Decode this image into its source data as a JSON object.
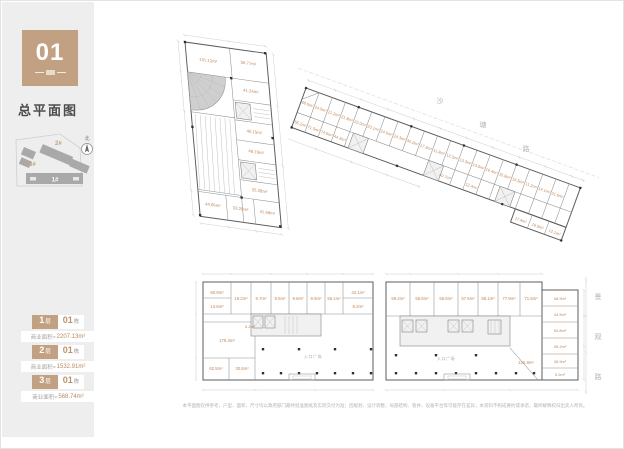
{
  "sidebar": {
    "badge": {
      "number": "01"
    },
    "title": "总平面图",
    "site_map": {
      "building_1": "1#",
      "building_2": "2#",
      "building_3": "3#",
      "north": "北"
    },
    "legend": [
      {
        "floor_num": "1",
        "floor_unit": "层",
        "bldg_num": "01",
        "bldg_unit": "栋",
        "area_prefix": "商业面积≈",
        "area_value": "2207.13m²"
      },
      {
        "floor_num": "2",
        "floor_unit": "层",
        "bldg_num": "01",
        "bldg_unit": "栋",
        "area_prefix": "商业面积≈",
        "area_value": "1532.91m²"
      },
      {
        "floor_num": "3",
        "floor_unit": "层",
        "bldg_num": "01",
        "bldg_unit": "栋",
        "area_prefix": "商业面积≈",
        "area_value": "568.74m²"
      }
    ]
  },
  "roads": {
    "top_chars": [
      "沙",
      "塘",
      "路"
    ],
    "right_chars": [
      "景",
      "观",
      "路"
    ]
  },
  "plans": {
    "plan1": {
      "rooms": [
        "131.12m²",
        "56.77m²",
        "41.24m²",
        "40.15m²",
        "48.19m²",
        "35.28m²",
        "44.06m²",
        "33.28m²",
        "41.68m²"
      ]
    },
    "plan2": {
      "rooms_top": [
        "68.5m²",
        "24.5m²",
        "21.2m²",
        "21.8m²",
        "22.0m²",
        "23.1m²",
        "24.6m²",
        "24.3m²",
        "30.2m²",
        "17.3m²",
        "11.8m²",
        "13.3m²",
        "13.3m²",
        "13.5m²",
        "16.4m²",
        "15.8m²"
      ],
      "rooms_right": [
        "16.5m²",
        "11.2m²",
        "14.1m²",
        "21.6m²",
        "17.4m²",
        "16.5m²",
        "12.1m²"
      ],
      "rooms_bottom": [
        "55.2m²",
        "71.5m²",
        "74.5m²",
        "44.3m²",
        "40.7m²",
        "12.4m²"
      ]
    },
    "plan3": {
      "rooms_top": [
        "60.9m²",
        "13.6m²",
        "19.2m²",
        "9.7m²",
        "9.5m²",
        "9.6m²",
        "9.9m²",
        "56.1m²",
        "42.1m²",
        "8.2m²"
      ],
      "rooms_left": [
        "179.3m²",
        "62.5m²",
        "30.6m²",
        "5.2m²"
      ],
      "open_label": "入口广场"
    },
    "plan4": {
      "rooms_top": [
        "59.2m²",
        "56.6m²",
        "56.6m²",
        "57.5m²",
        "58.1m²",
        "77.9m²",
        "71.5m²"
      ],
      "rooms_right": [
        "48.9m²",
        "44.5m²",
        "54.8m²",
        "45.2m²",
        "45.9m²",
        "9.2m²"
      ],
      "open_area": "126.8m²",
      "open_label": "入口广场"
    }
  },
  "footer": {
    "disclaimer": "本平面图仅供参考，户型、面积、尺寸均以政府部门最终批准图纸及实际交付为准；因规划、设计调整，局部结构、管井、设备平台等可能存在差异；本资料不构成要约或承诺，最终解释权归出卖人所有。"
  }
}
